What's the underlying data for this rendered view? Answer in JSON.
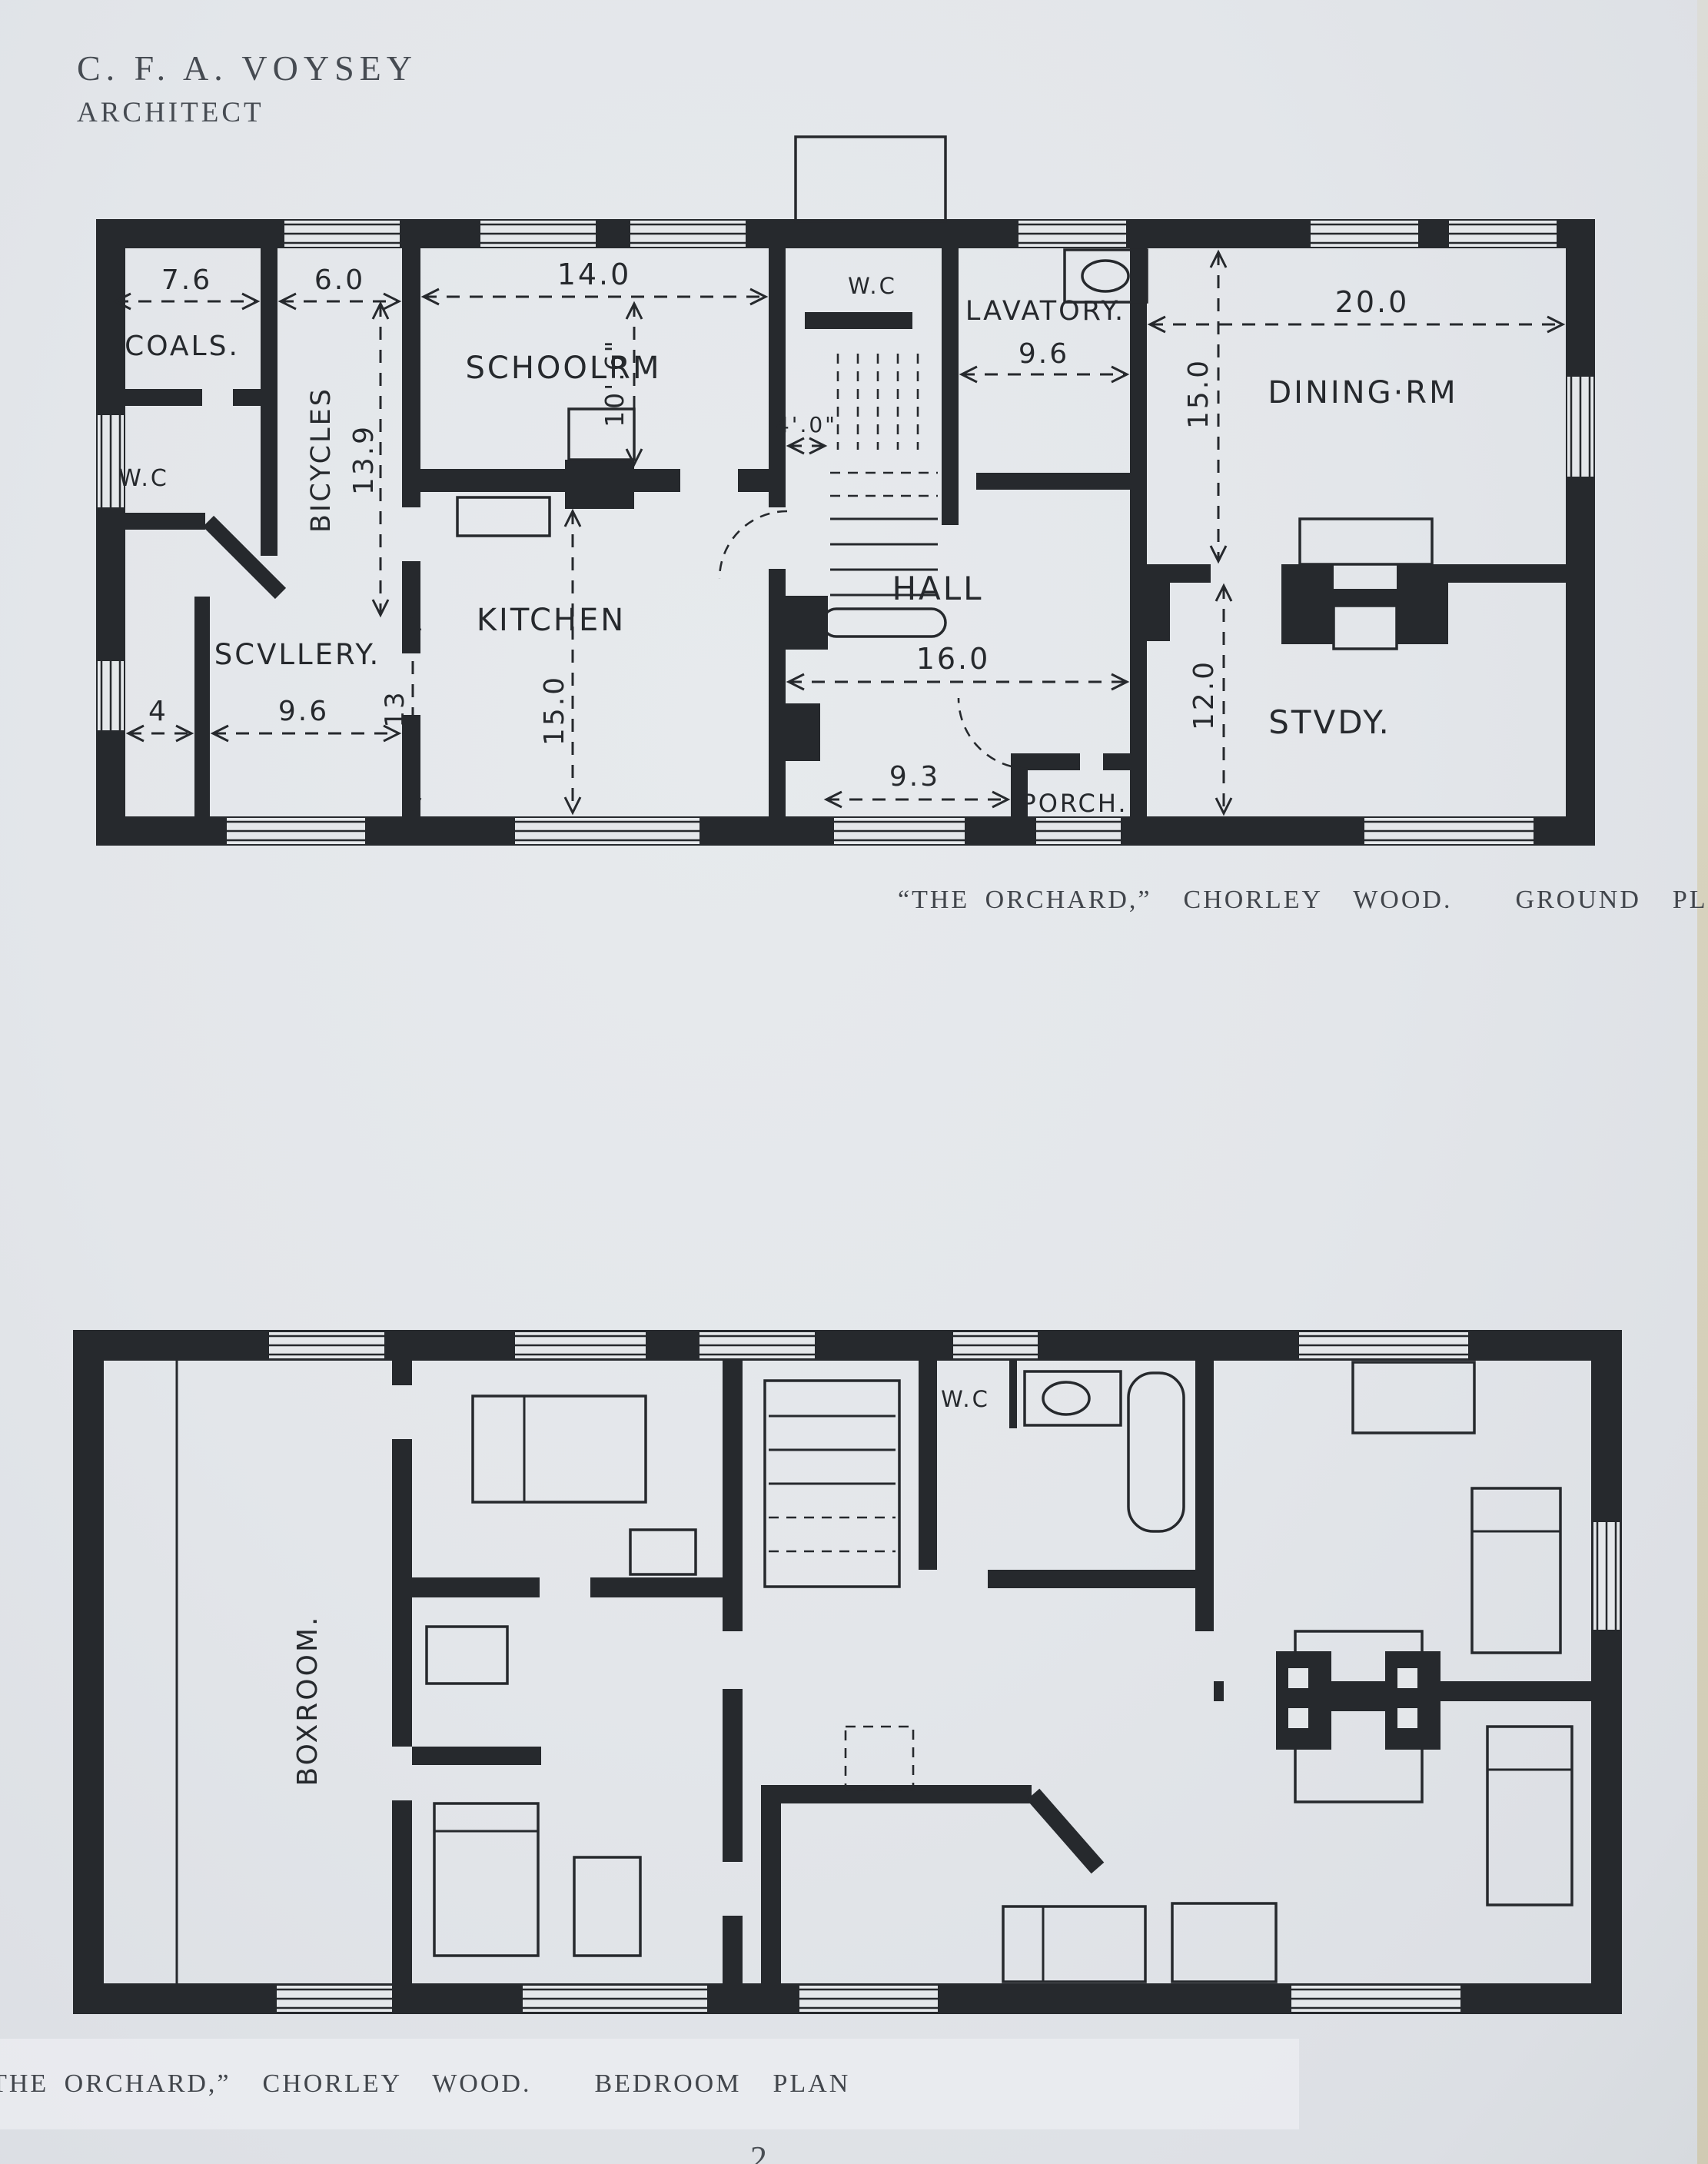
{
  "header": {
    "line1": "C. F. A. VOYSEY",
    "line2": "ARCHITECT"
  },
  "ground_plan": {
    "caption": "“THE ORCHARD,”  CHORLEY  WOOD.    GROUND  PLAN",
    "rooms": {
      "coals": "COALS.",
      "wc_left": "W.C",
      "bicycles": "BICYCLES",
      "schoolroom": "SCHOOLRM",
      "kitchen": "KITCHEN",
      "scullery": "SCVLLERY.",
      "wc_center": "W.C",
      "lavatory": "LAVATORY.",
      "hall": "HALL",
      "porch": "PORCH.",
      "dining": "DINING·RM",
      "study": "STVDY."
    },
    "dims": {
      "coals_w": "7.6",
      "bicycles_w": "6.0",
      "schoolroom_w": "14.0",
      "schoolroom_d": "10'.6\"",
      "bicycles_d": "13.9",
      "stair_w": "4'.0\"",
      "lavatory_w": "9.6",
      "dining_w": "20.0",
      "dining_d": "15.0",
      "hall_w": "16.0",
      "hall_porch": "9.3",
      "study_d": "12.0",
      "kitchen_d": "15.0",
      "scullery_w": "9.6",
      "passage_w": "4",
      "scullery_d": "13"
    }
  },
  "bedroom_plan": {
    "caption": "“THE ORCHARD,”  CHORLEY  WOOD.    BEDROOM  PLAN",
    "rooms": {
      "boxroom": "BOXROOM.",
      "wc": "W.C"
    }
  },
  "page_number_partial": "2"
}
